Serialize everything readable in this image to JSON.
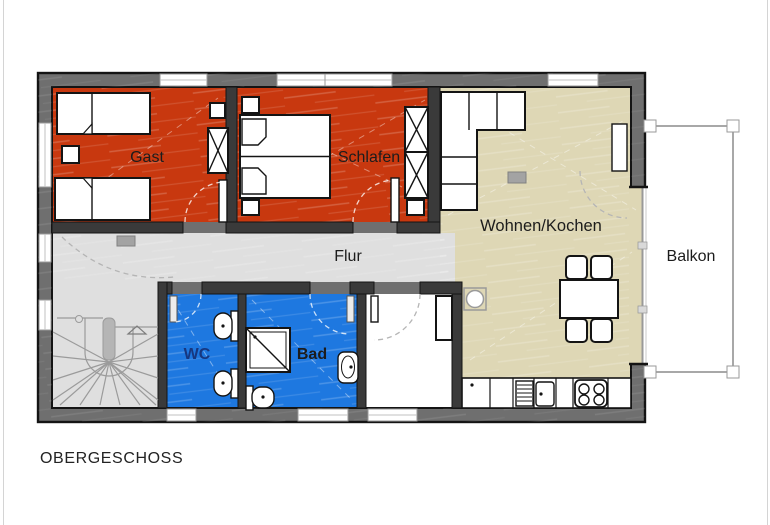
{
  "title": "OBERGESCHOSS",
  "rooms": {
    "gast": {
      "label": "Gast"
    },
    "schlafen": {
      "label": "Schlafen"
    },
    "wohnen_kochen": {
      "label": "Wohnen/Kochen"
    },
    "flur": {
      "label": "Flur"
    },
    "wc": {
      "label": "WC"
    },
    "bad": {
      "label": "Bad"
    },
    "balkon": {
      "label": "Balkon"
    }
  },
  "colors": {
    "wall_gray": "#6f6f6f",
    "outline_black": "#141414",
    "bedroom_red": "#c8380f",
    "bath_blue": "#1e78e0",
    "living_beige": "#ded7b5",
    "hallway_gray": "#dfdfdf",
    "balcony_rail_gray": "#a8a8a8",
    "wc_label_blue": "#17377f"
  }
}
